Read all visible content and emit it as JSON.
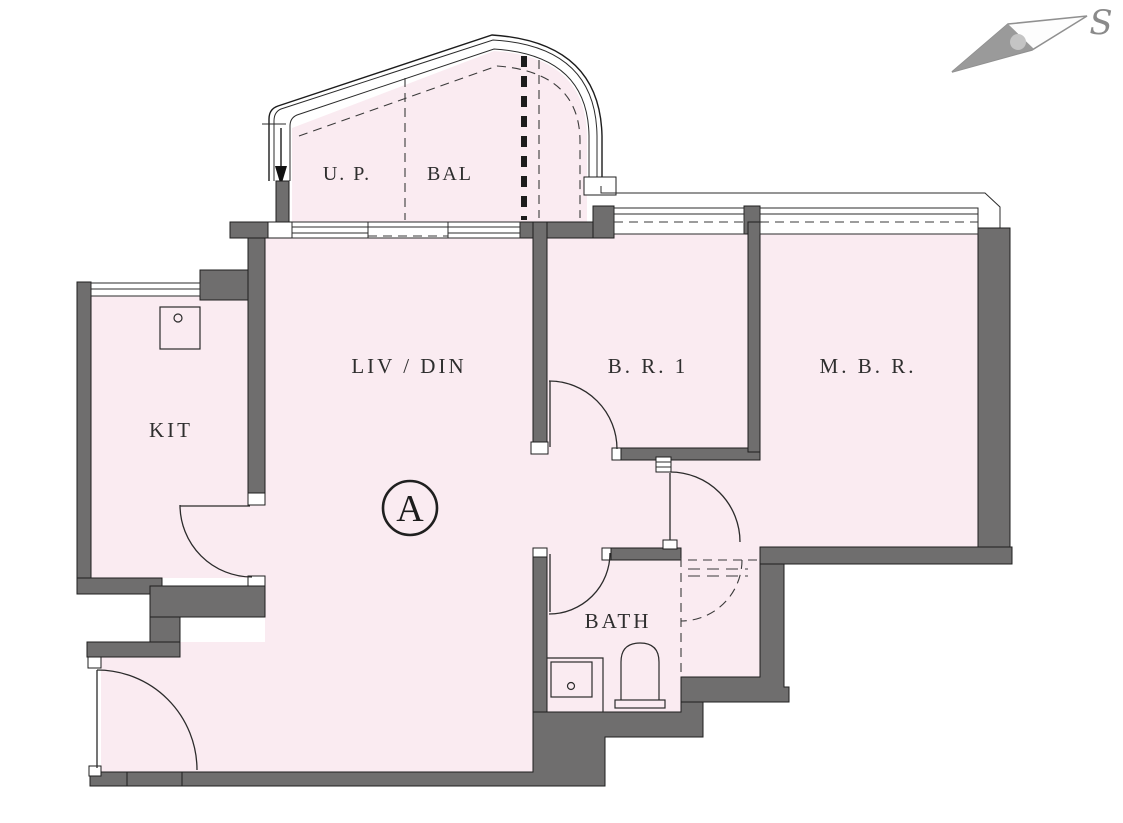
{
  "plan": {
    "unit_label": "A",
    "rooms": {
      "up": "U. P.",
      "bal": "BAL",
      "livdin": "LIV / DIN",
      "br1": "B. R. 1",
      "mbr": "M. B. R.",
      "kit": "KIT",
      "bath": "BATH"
    },
    "compass": {
      "south_label": "S"
    },
    "colors": {
      "floor": "#faebf1",
      "wall": "#6f6e6e",
      "line": "#2b2b2b",
      "background": "#ffffff"
    }
  }
}
